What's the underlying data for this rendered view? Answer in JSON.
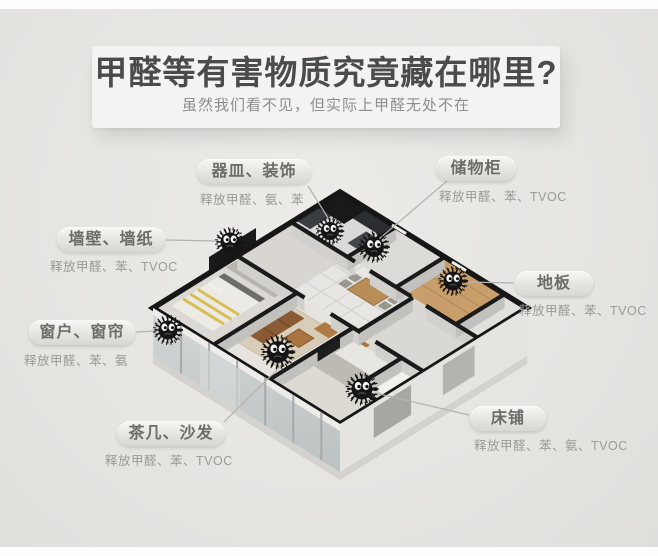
{
  "header": {
    "title": "甲醛等有害物质究竟藏在哪里?",
    "subtitle": "虽然我们看不见，但实际上甲醛无处不在"
  },
  "callouts": [
    {
      "name": "vessels-decor",
      "title": "器皿、装饰",
      "detail": "释放甲醛、氨、苯"
    },
    {
      "name": "storage-cabinet",
      "title": "储物柜",
      "detail": "释放甲醛、苯、TVOC"
    },
    {
      "name": "walls-wallpaper",
      "title": "墙壁、墙纸",
      "detail": "释放甲醛、苯、TVOC"
    },
    {
      "name": "floor",
      "title": "地板",
      "detail": "释放甲醛、苯、TVOC"
    },
    {
      "name": "windows-curtains",
      "title": "窗户、窗帘",
      "detail": "释放甲醛、苯、氨"
    },
    {
      "name": "tea-table-sofa",
      "title": "茶几、沙发",
      "detail": "释放甲醛、苯、TVOC"
    },
    {
      "name": "bed",
      "title": "床铺",
      "detail": "释放甲醛、苯、氨、TVOC"
    }
  ],
  "illustration": {
    "type": "3d-isometric-apartment-floorplan",
    "monster_icon": "black-spiky-pollutant-monster",
    "monster_count": 7
  },
  "colors": {
    "background": "#e6e5e2",
    "panel": "#f4f3f1",
    "title_text": "#4b4b49",
    "subtitle_text": "#8f8e8b",
    "pill_text": "#6d6c69",
    "detail_text": "#9c9a96",
    "wall_top": "#1a1a1a",
    "monster": "#151515",
    "wood_floor": "#c89f6b",
    "sofa_brown": "#8a5a34",
    "glass": "#c9cecf"
  }
}
